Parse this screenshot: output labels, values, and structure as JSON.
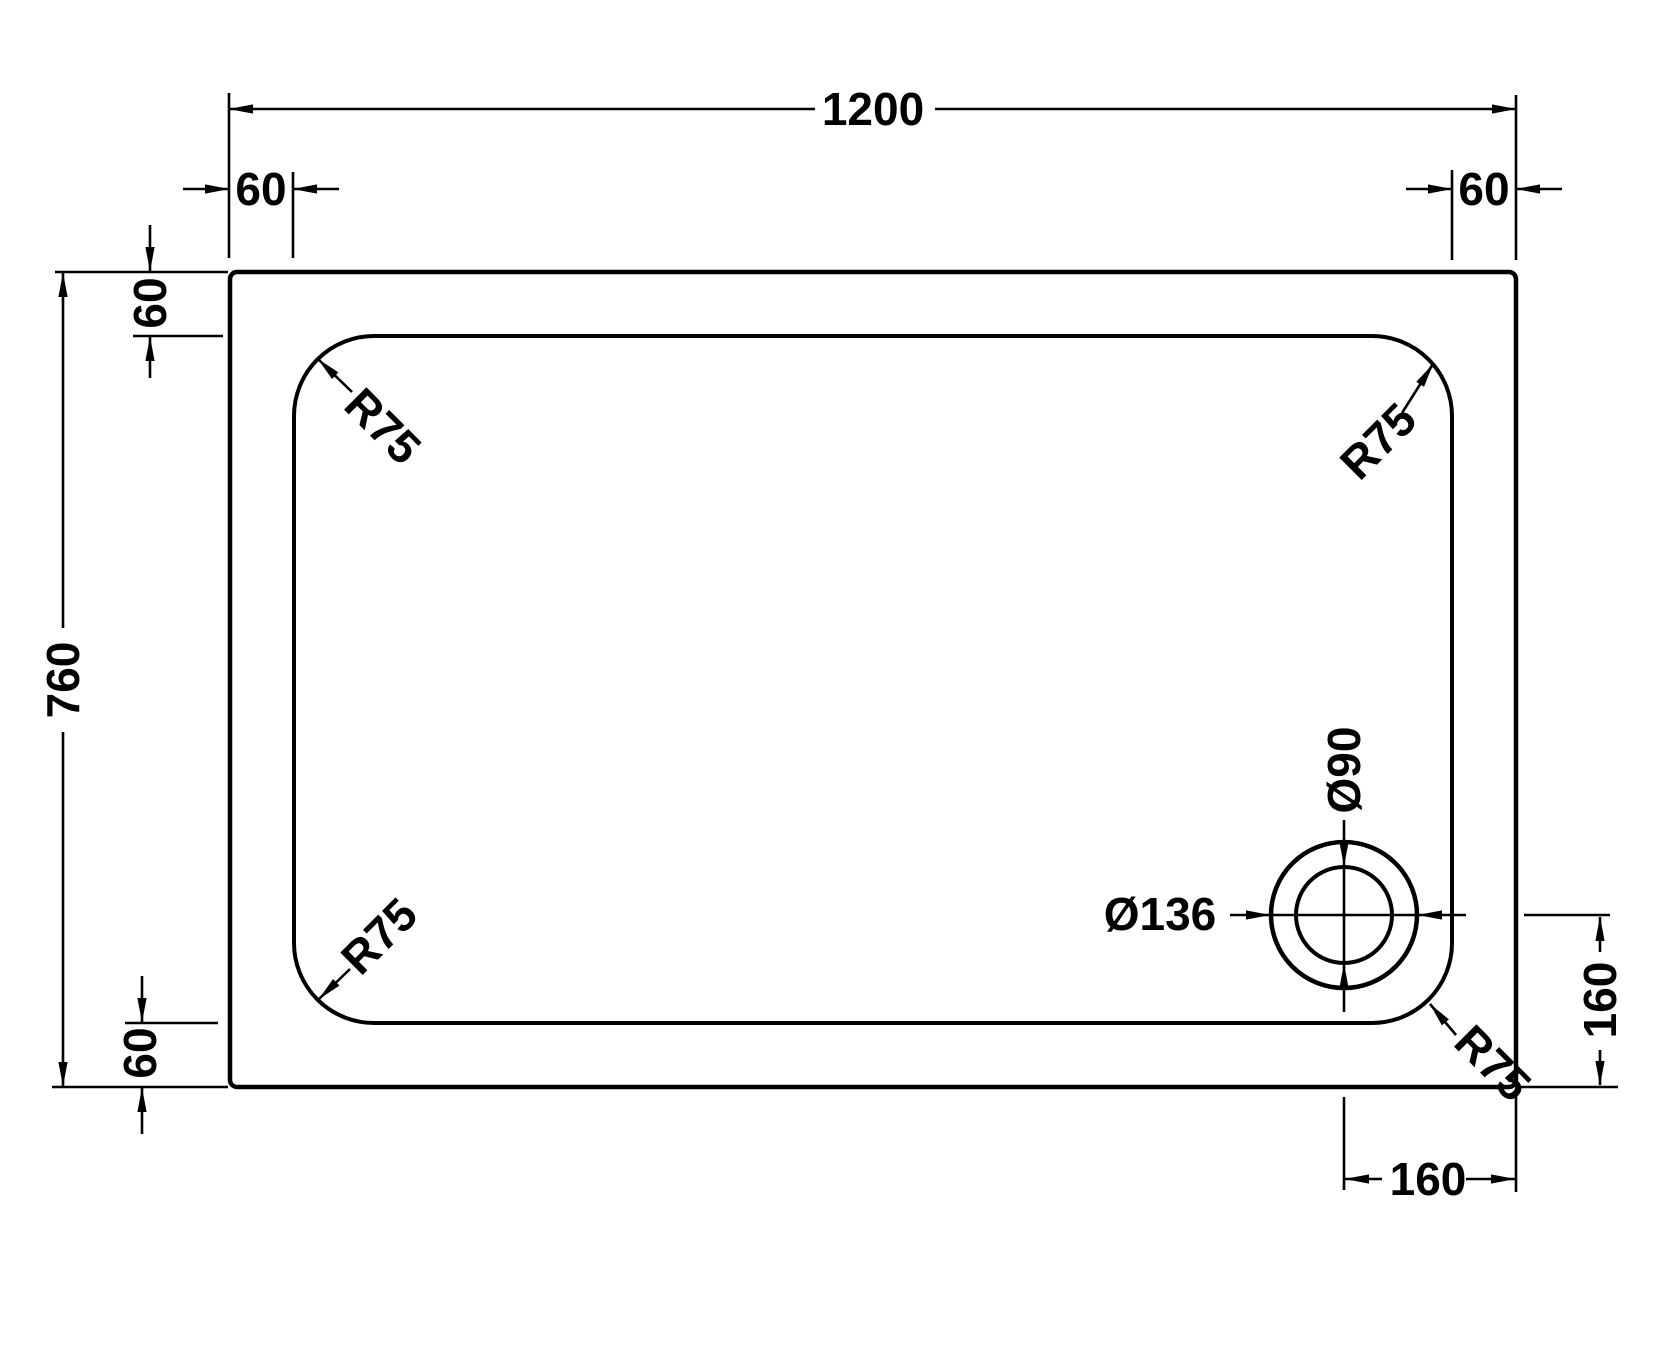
{
  "colors": {
    "background": "#ffffff",
    "ink": "#000000"
  },
  "labels": {
    "overall_width": "1200",
    "overall_height": "760",
    "top_left_edge_offset": "60",
    "top_right_edge_offset": "60",
    "left_top_edge_offset": "60",
    "left_bottom_edge_offset": "60",
    "corner_radius_top_left": "R75",
    "corner_radius_top_right": "R75",
    "corner_radius_bottom_left": "R75",
    "corner_radius_bottom_right": "R75",
    "drain_inner_diameter": "Ø90",
    "drain_outer_diameter": "Ø136",
    "drain_offset_from_right": "160",
    "drain_offset_from_bottom": "160"
  }
}
